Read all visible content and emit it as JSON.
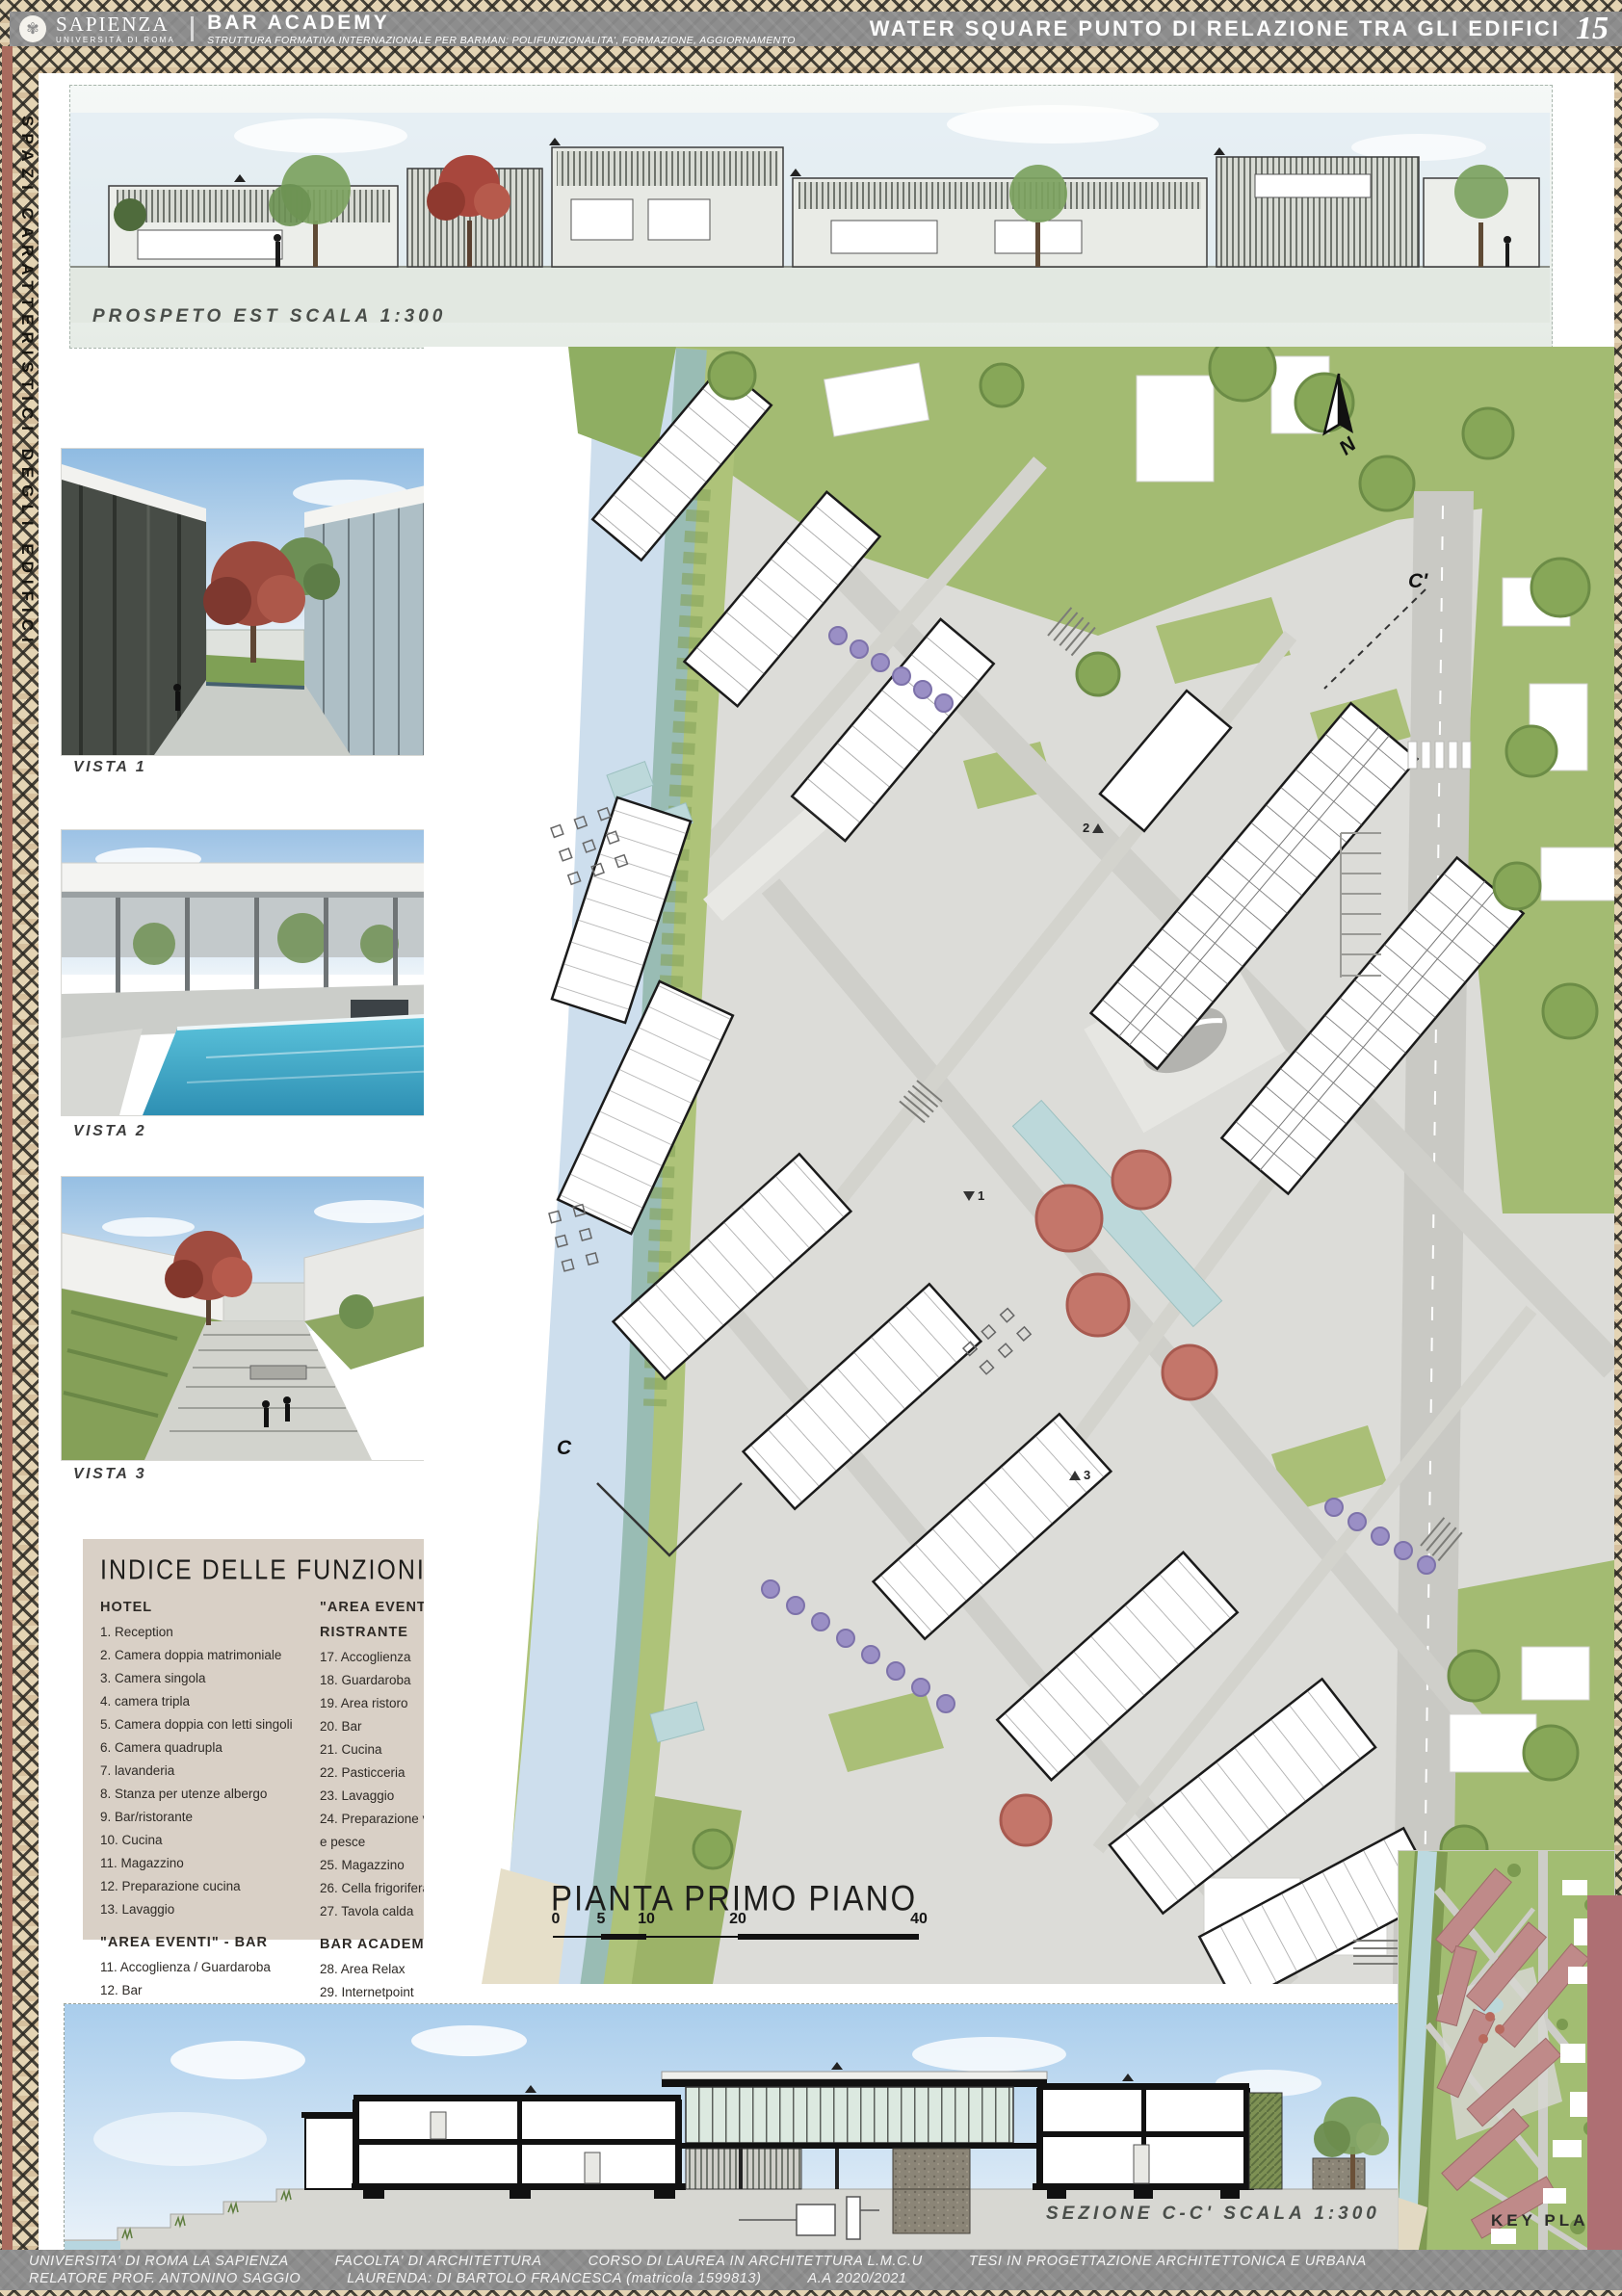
{
  "header": {
    "university": "SAPIENZA",
    "university_sub": "UNIVERSITÀ DI ROMA",
    "project_title": "BAR ACADEMY",
    "project_subtitle": "STRUTTURA FORMATIVA INTERNAZIONALE PER BARMAN: POLIFUNZIONALITA', FORMAZIONE, AGGIORNAMENTO",
    "board_title": "WATER SQUARE PUNTO DI RELAZIONE TRA GLI EDIFICI",
    "board_number": "15"
  },
  "sidebar": {
    "vertical_text": "SPAZI CARATTERISTICI DEGLI EDIFICI"
  },
  "labels": {
    "elevation": "PROSPETO EST SCALA 1:300",
    "plan": "PIANTA PRIMO PIANO",
    "section": "SEZIONE C-C' SCALA 1:300",
    "keyplan": "KEY PLAN",
    "north": "N",
    "marker_c": "C",
    "marker_c1": "C'",
    "view_marker_1": "1",
    "view_marker_2": "2",
    "view_marker_3": "3"
  },
  "scale_bar": {
    "ticks": [
      "0",
      "5",
      "10",
      "20",
      "40"
    ]
  },
  "vistas": [
    {
      "label": "VISTA 1"
    },
    {
      "label": "VISTA 2"
    },
    {
      "label": "VISTA 3"
    }
  ],
  "index_panel": {
    "title": "INDICE DELLE FUNZIONI",
    "groups": [
      {
        "heading": "HOTEL",
        "items": [
          "1. Reception",
          "2. Camera doppia matrimoniale",
          "3. Camera singola",
          "4. camera tripla",
          "5. Camera doppia con letti singoli",
          "6. Camera quadrupla",
          "7. lavanderia",
          "8. Stanza per utenze albergo",
          "9. Bar/ristorante",
          "10. Cucina",
          "11. Magazzino",
          "12. Preparazione cucina",
          "13. Lavaggio"
        ]
      },
      {
        "heading": "\"AREA EVENTI\" - BAR",
        "items": [
          "11. Accoglienza / Guardaroba",
          "12. Bar",
          "13. Cucina",
          "14. Sala con tavoli",
          "15. sale private",
          "16. Console per la musica"
        ]
      },
      {
        "heading": "\"AREA EVENTI\" - RISTRANTE",
        "items": [
          "17. Accoglienza",
          "18. Guardaroba",
          "19. Area ristoro",
          "20. Bar",
          "21. Cucina",
          "22. Pasticceria",
          "23. Lavaggio",
          "24. Preparazione verdure e pesce",
          "25. Magazzino",
          "26. Cella frigorifera",
          "27. Tavola calda"
        ]
      },
      {
        "heading": "BAR ACADEMY",
        "items": [
          "28. Area Relax",
          "29. Internetpoint",
          "30. Aule corsi",
          "31. Aule master",
          "32. Magazzino",
          "33. Uffici"
        ]
      }
    ]
  },
  "footer": {
    "line1": [
      "UNIVERSITA' DI ROMA LA SAPIENZA",
      "FACOLTA' DI ARCHITETTURA",
      "CORSO DI LAUREA IN ARCHITETTURA L.M.C.U",
      "TESI IN PROGETTAZIONE ARCHITETTONICA E URBANA"
    ],
    "line2": [
      "RELATORE PROF. ANTONINO SAGGIO",
      "LAURENDA: DI BARTOLO FRANCESCA (matricola 1599813)",
      "A.A 2020/2021"
    ]
  },
  "colors": {
    "pattern_tan": "#e4d4b4",
    "pattern_ink": "#2b2822",
    "band_gray": "#8d8d8d",
    "accent_red": "#a96b5e",
    "mauve_band": "#ae6f73",
    "river_blue": "#cddeed",
    "grass_green": "#a3bb72",
    "plaza_gray": "#dcdcd8",
    "rose_building": "#bf8a89",
    "index_bg": "#d9d0c6"
  }
}
